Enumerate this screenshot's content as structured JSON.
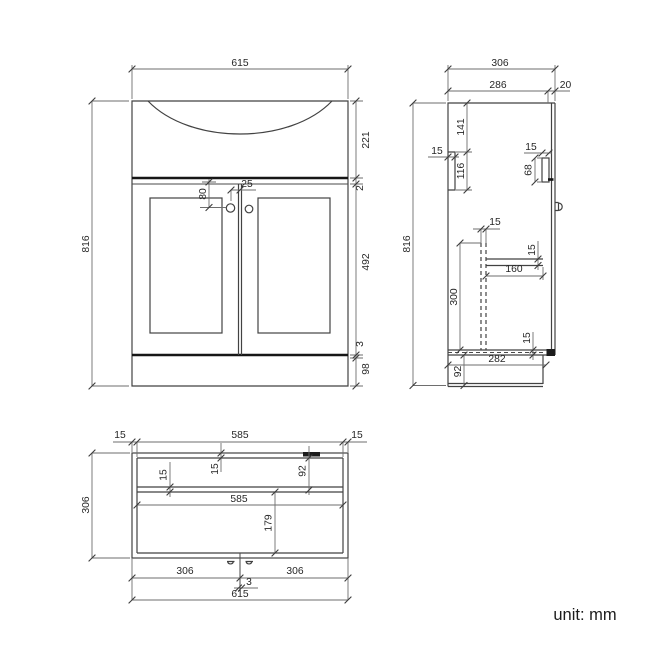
{
  "drawing": {
    "footer": {
      "unit_label": "unit: mm"
    },
    "views": {
      "front": {
        "dims": {
          "total_width": "615",
          "total_height": "816",
          "basin_height": "221",
          "counter_gap": "2",
          "door_height": "492",
          "bottom_gap": "3",
          "plinth_height": "98",
          "handle_drop": "80",
          "handle_spacing": "25"
        }
      },
      "side": {
        "dims": {
          "total_depth": "306",
          "cabinet_depth": "286",
          "door_thickness": "20",
          "total_height": "816",
          "bracket_top_offset": "141",
          "bracket_thickness": "15",
          "bracket_height": "116",
          "hinge_inset": "15",
          "hinge_height": "68",
          "divider_thickness": "15",
          "divider_height": "300",
          "shelf_thickness": "15",
          "shelf_depth": "160",
          "bottom_panel_thickness": "15",
          "bottom_depth": "282",
          "plinth_height": "92"
        }
      },
      "plan": {
        "dims": {
          "left_wall": "15",
          "inner_width_top": "585",
          "right_wall": "15",
          "total_depth": "306",
          "back_wall": "15",
          "rail_thickness": "15",
          "back_section_depth": "92",
          "inner_width": "585",
          "front_section_depth": "179",
          "left_door_width": "306",
          "right_door_width": "306",
          "door_gap": "3",
          "total_width": "615"
        }
      }
    }
  }
}
